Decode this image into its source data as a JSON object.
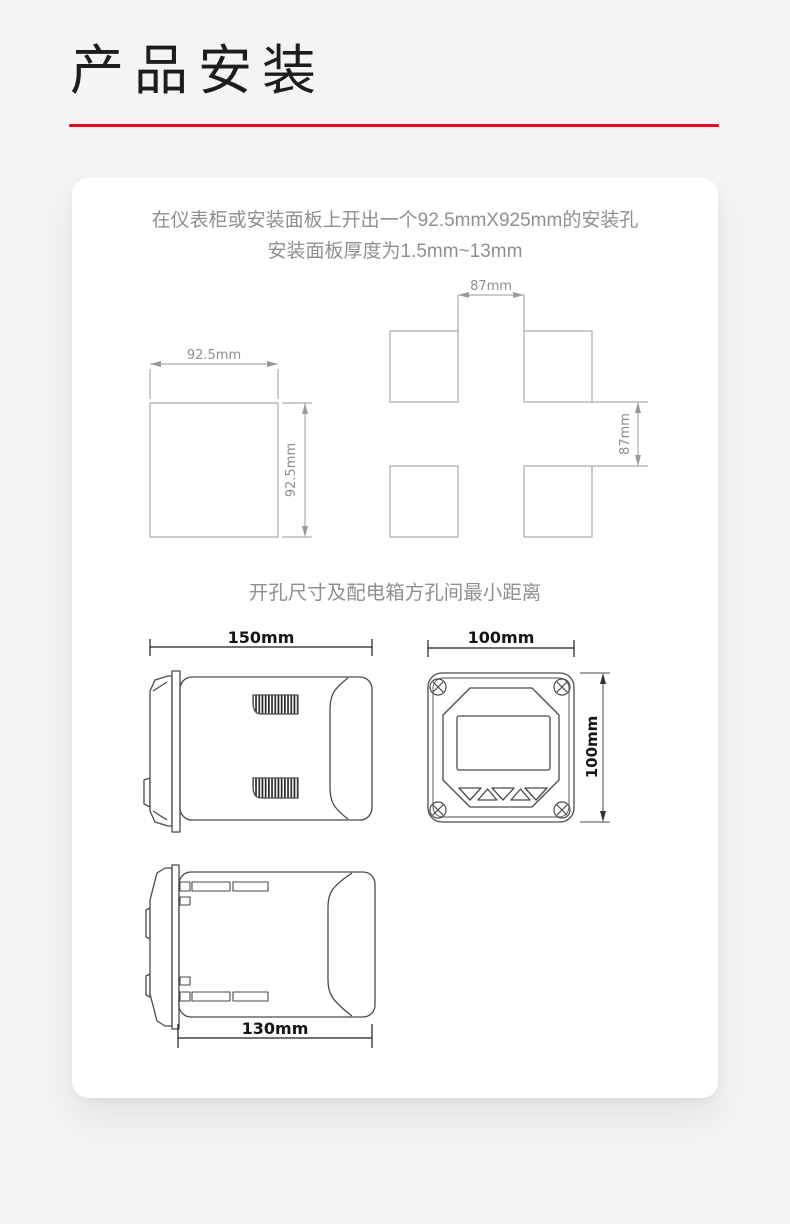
{
  "page": {
    "title": "产品安装"
  },
  "card": {
    "intro": {
      "line1": "在仪表柜或安装面板上开出一个92.5mmX925mm的安装孔",
      "line2": "安装面板厚度为1.5mm~13mm"
    },
    "caption": "开孔尺寸及配电箱方孔间最小距离",
    "diagrams": {
      "cutout": {
        "width_label": "92.5mm",
        "height_label": "92.5mm"
      },
      "spacing": {
        "gap_h_label": "87mm",
        "gap_v_label": "87mm"
      },
      "side_view": {
        "width_label": "150mm"
      },
      "front_view": {
        "width_label": "100mm",
        "height_label": "100mm"
      },
      "top_view": {
        "width_label": "130mm"
      }
    }
  },
  "colors": {
    "accent_red": "#c41f1f",
    "background": "#f4f4f5",
    "card": "#ffffff",
    "cad_line": "#9a9a9a",
    "device_line": "#4a4a4a",
    "gray_text": "#8f8f8f",
    "title_text": "#1d1d1d"
  }
}
